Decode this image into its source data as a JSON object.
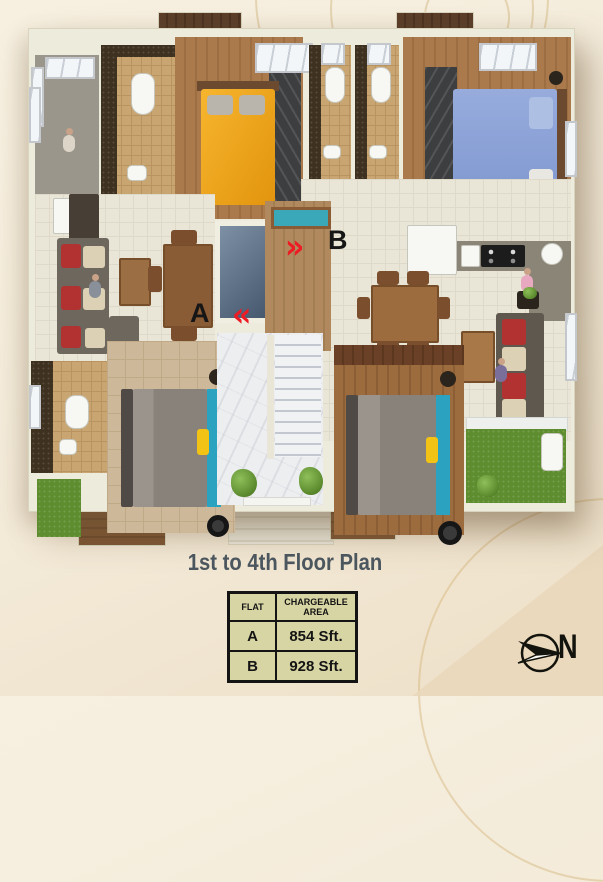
{
  "plan": {
    "flat_a_label": "A",
    "flat_b_label": "B",
    "entry_marker_a": "«",
    "entry_marker_b": "»"
  },
  "footer": {
    "title": "1st to 4th Floor Plan"
  },
  "area_table": {
    "col_flat": "FLAT",
    "col_area": "CHARGEABLE AREA",
    "rows": [
      {
        "flat": "A",
        "area": "854 Sft."
      },
      {
        "flat": "B",
        "area": "928 Sft."
      }
    ]
  },
  "compass": {
    "north_label": "N"
  },
  "colors": {
    "accent_red": "#ed1c24",
    "table_bg": "#d8d5a4",
    "title_text": "#4b565e",
    "background": "#f3ead8",
    "wall": "#edebdc"
  }
}
